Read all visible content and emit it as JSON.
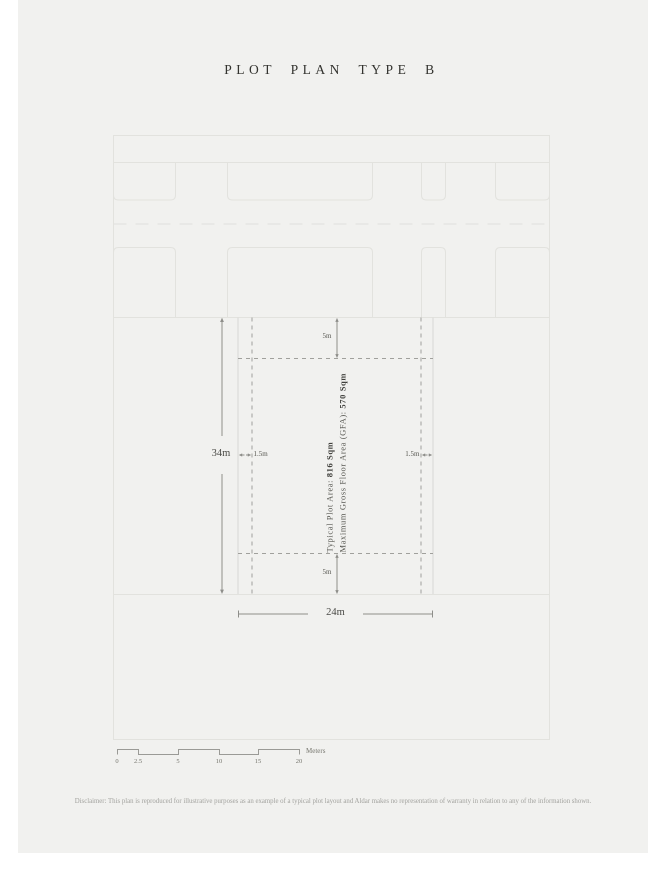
{
  "title": "PLOT PLAN TYPE B",
  "dimensions": {
    "plot_height": "34m",
    "plot_width": "24m",
    "front_setback": "5m",
    "rear_setback": "5m",
    "left_setback": "1.5m",
    "right_setback": "1.5m"
  },
  "plot_info": {
    "line1_label": "Typical Plot Area: ",
    "line1_value": "816 Sqm",
    "line2_label": "Maximum Gross Floor Area (GFA): ",
    "line2_value": "570 Sqm"
  },
  "scale_bar": {
    "ticks": [
      "0",
      "2.5",
      "5",
      "10",
      "15",
      "20"
    ],
    "unit": "Meters"
  },
  "disclaimer": "Disclaimer: This plan is reproduced for illustrative purposes as an example of a typical plot layout and Aldar makes no representation of warranty in relation to any of the information shown.",
  "colors": {
    "canvas_background": "#f1f1ef",
    "plan_line": "#e2e2de",
    "featured_plot_line": "#d8d8d4",
    "setback_dash": "#a0a09c",
    "dimension_line": "#8e8e8a",
    "title_text": "#33332f"
  }
}
